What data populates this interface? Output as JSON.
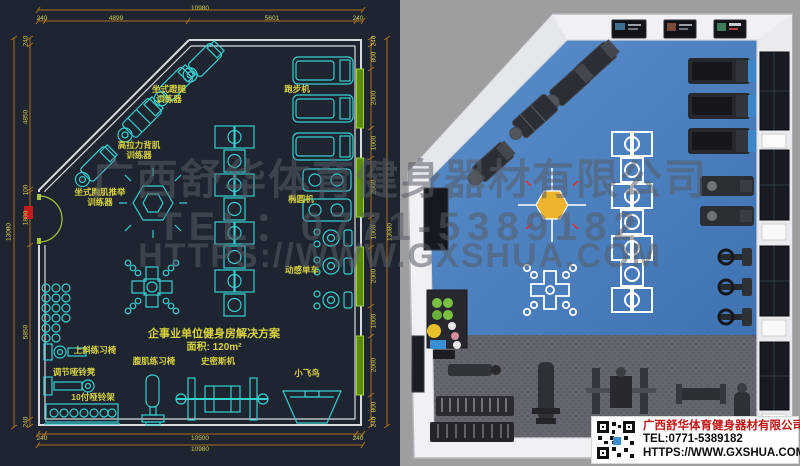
{
  "watermark": {
    "line1": "广西舒华体育健身器材有限公司",
    "line2": "TEL：0771-5389182",
    "line3": "HTTPS://WWW.GXSHUA.COM"
  },
  "cad_plan": {
    "title": {
      "line1": "企事业单位健身房解决方案",
      "line2": "面积: 120m²"
    },
    "equipment_labels": [
      {
        "text": "坐式蹬腿\n训练器",
        "x": 169,
        "y": 85
      },
      {
        "text": "高拉力背肌\n训练器",
        "x": 139,
        "y": 141
      },
      {
        "text": "坐式胸肌推举\n训练器",
        "x": 100,
        "y": 188
      },
      {
        "text": "跑步机",
        "x": 297,
        "y": 85
      },
      {
        "text": "椭圆机",
        "x": 301,
        "y": 195
      },
      {
        "text": "动感单车",
        "x": 302,
        "y": 266
      },
      {
        "text": "上斜练习椅",
        "x": 95,
        "y": 346
      },
      {
        "text": "调节哑铃凳",
        "x": 74,
        "y": 368
      },
      {
        "text": "10付哑铃架",
        "x": 93,
        "y": 393
      },
      {
        "text": "腹肌练习椅",
        "x": 154,
        "y": 357
      },
      {
        "text": "史密斯机",
        "x": 218,
        "y": 357
      },
      {
        "text": "小飞鸟",
        "x": 307,
        "y": 369
      }
    ],
    "dim_texts": [
      {
        "t": "10980",
        "x": 200,
        "y": 5
      },
      {
        "t": "240",
        "x": 42,
        "y": 15
      },
      {
        "t": "4899",
        "x": 116,
        "y": 15
      },
      {
        "t": "5601",
        "x": 272,
        "y": 15
      },
      {
        "t": "240",
        "x": 358,
        "y": 15
      },
      {
        "t": "240",
        "x": 42,
        "y": 435
      },
      {
        "t": "10500",
        "x": 200,
        "y": 435
      },
      {
        "t": "240",
        "x": 358,
        "y": 435
      },
      {
        "t": "10980",
        "x": 200,
        "y": 446
      },
      {
        "t": "13080",
        "x": 9,
        "y": 232,
        "rot": 1
      },
      {
        "t": "240",
        "x": 26,
        "y": 41,
        "rot": 1
      },
      {
        "t": "4850",
        "x": 26,
        "y": 117,
        "rot": 1
      },
      {
        "t": "100",
        "x": 26,
        "y": 190,
        "rot": 1
      },
      {
        "t": "1800",
        "x": 26,
        "y": 218,
        "rot": 1
      },
      {
        "t": "5850",
        "x": 26,
        "y": 332,
        "rot": 1
      },
      {
        "t": "240",
        "x": 26,
        "y": 422,
        "rot": 1
      },
      {
        "t": "240",
        "x": 374,
        "y": 41,
        "rot": 1
      },
      {
        "t": "800",
        "x": 374,
        "y": 57,
        "rot": 1
      },
      {
        "t": "2000",
        "x": 374,
        "y": 98,
        "rot": 1
      },
      {
        "t": "1000",
        "x": 374,
        "y": 143,
        "rot": 1
      },
      {
        "t": "2000",
        "x": 374,
        "y": 187,
        "rot": 1
      },
      {
        "t": "1000",
        "x": 374,
        "y": 232,
        "rot": 1
      },
      {
        "t": "2000",
        "x": 374,
        "y": 276,
        "rot": 1
      },
      {
        "t": "1000",
        "x": 374,
        "y": 321,
        "rot": 1
      },
      {
        "t": "2000",
        "x": 374,
        "y": 365,
        "rot": 1
      },
      {
        "t": "800",
        "x": 374,
        "y": 407,
        "rot": 1
      },
      {
        "t": "240",
        "x": 374,
        "y": 422,
        "rot": 1
      },
      {
        "t": "13080",
        "x": 390,
        "y": 232,
        "rot": 1
      }
    ]
  },
  "render_3d": {
    "info_card": {
      "company": "广西舒华体育健身器材有限公司",
      "tel": "TEL:0771-5389182",
      "url": "HTTPS://WWW.GXSHUA.COM"
    }
  },
  "colors": {
    "cad_bg": "#1e2430",
    "cad_equipment": "#35d0d0",
    "cad_label": "#d9d33c",
    "cad_dim_line": "#a9721d",
    "cad_dim_text": "#d6cc4b",
    "cad_wall": "#d9dadd",
    "window_green": "#7fae24",
    "door_arc": "#a9c836",
    "door_marker_red": "#c41c1c",
    "floor_blue": "#4a80c2",
    "floor_dark": "#63666c",
    "wall_white": "#f0f1f4",
    "bg_gray": "#9c9ea0",
    "marking_white": "#ffffff",
    "hex_yellow": "#f0b42c",
    "console_blue": "#3f86c9",
    "card_red": "#c11414"
  }
}
